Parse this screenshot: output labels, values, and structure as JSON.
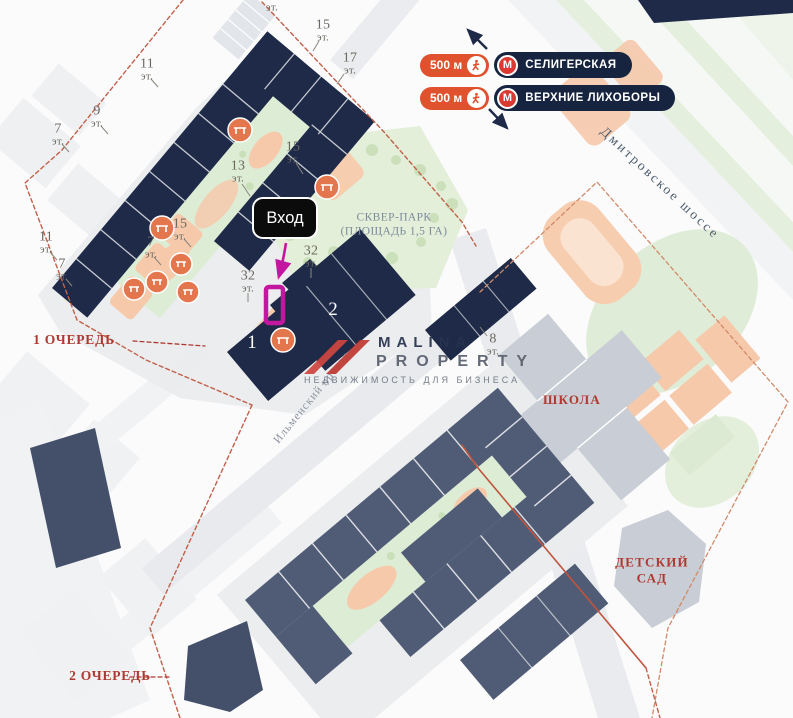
{
  "canvas": {
    "w": 793,
    "h": 718
  },
  "metro": {
    "m_letter": "М",
    "rows": [
      {
        "distance": "500 м",
        "station": "СЕЛИГЕРСКАЯ"
      },
      {
        "distance": "500 м",
        "station": "ВЕРХНИЕ ЛИХОБОРЫ"
      }
    ]
  },
  "phases": {
    "phase1": "1 ОЧЕРЕДЬ",
    "phase2": "2 ОЧЕРЕДЬ"
  },
  "streets": {
    "highway": "Дмитровское шоссе",
    "lane": "Ильменский проезд"
  },
  "park": {
    "line1": "СКВЕР-ПАРК",
    "line2": "(ПЛОЩАДЬ 1,5 ГА)"
  },
  "pois": {
    "school": "ШКОЛА",
    "kg1": "ДЕТСКИЙ",
    "kg2": "САД"
  },
  "entrance": {
    "label": "Вход"
  },
  "towers": {
    "t1": "1",
    "t2": "2"
  },
  "floor_unit": "эт.",
  "floor_labels": [
    {
      "num": "",
      "x": 272,
      "y": 8
    },
    {
      "num": "15",
      "x": 323,
      "y": 31
    },
    {
      "num": "17",
      "x": 350,
      "y": 64
    },
    {
      "num": "11",
      "x": 147,
      "y": 70
    },
    {
      "num": "9",
      "x": 97,
      "y": 117
    },
    {
      "num": "7",
      "x": 58,
      "y": 135
    },
    {
      "num": "15",
      "x": 293,
      "y": 153
    },
    {
      "num": "13",
      "x": 238,
      "y": 172
    },
    {
      "num": "15",
      "x": 180,
      "y": 230
    },
    {
      "num": "7",
      "x": 151,
      "y": 248
    },
    {
      "num": "11",
      "x": 46,
      "y": 243
    },
    {
      "num": "7",
      "x": 62,
      "y": 270
    },
    {
      "num": "32",
      "x": 311,
      "y": 257
    },
    {
      "num": "32",
      "x": 248,
      "y": 282
    },
    {
      "num": "8",
      "x": 493,
      "y": 345
    }
  ],
  "logo": {
    "name1": "MALINA",
    "name2": "PROPERTY",
    "tagline": "НЕДВИЖИМОСТЬ ДЛЯ БИЗНЕСА"
  },
  "colors": {
    "building_navy": "#1e2a47",
    "building_slate": "#505c76",
    "accent_magenta": "#c417a0",
    "metro_orange": "#e0512d",
    "metro_navy": "#172440",
    "metro_red": "#d93a31",
    "label_red": "#b0392f",
    "boundary_red": "#c2604a"
  }
}
